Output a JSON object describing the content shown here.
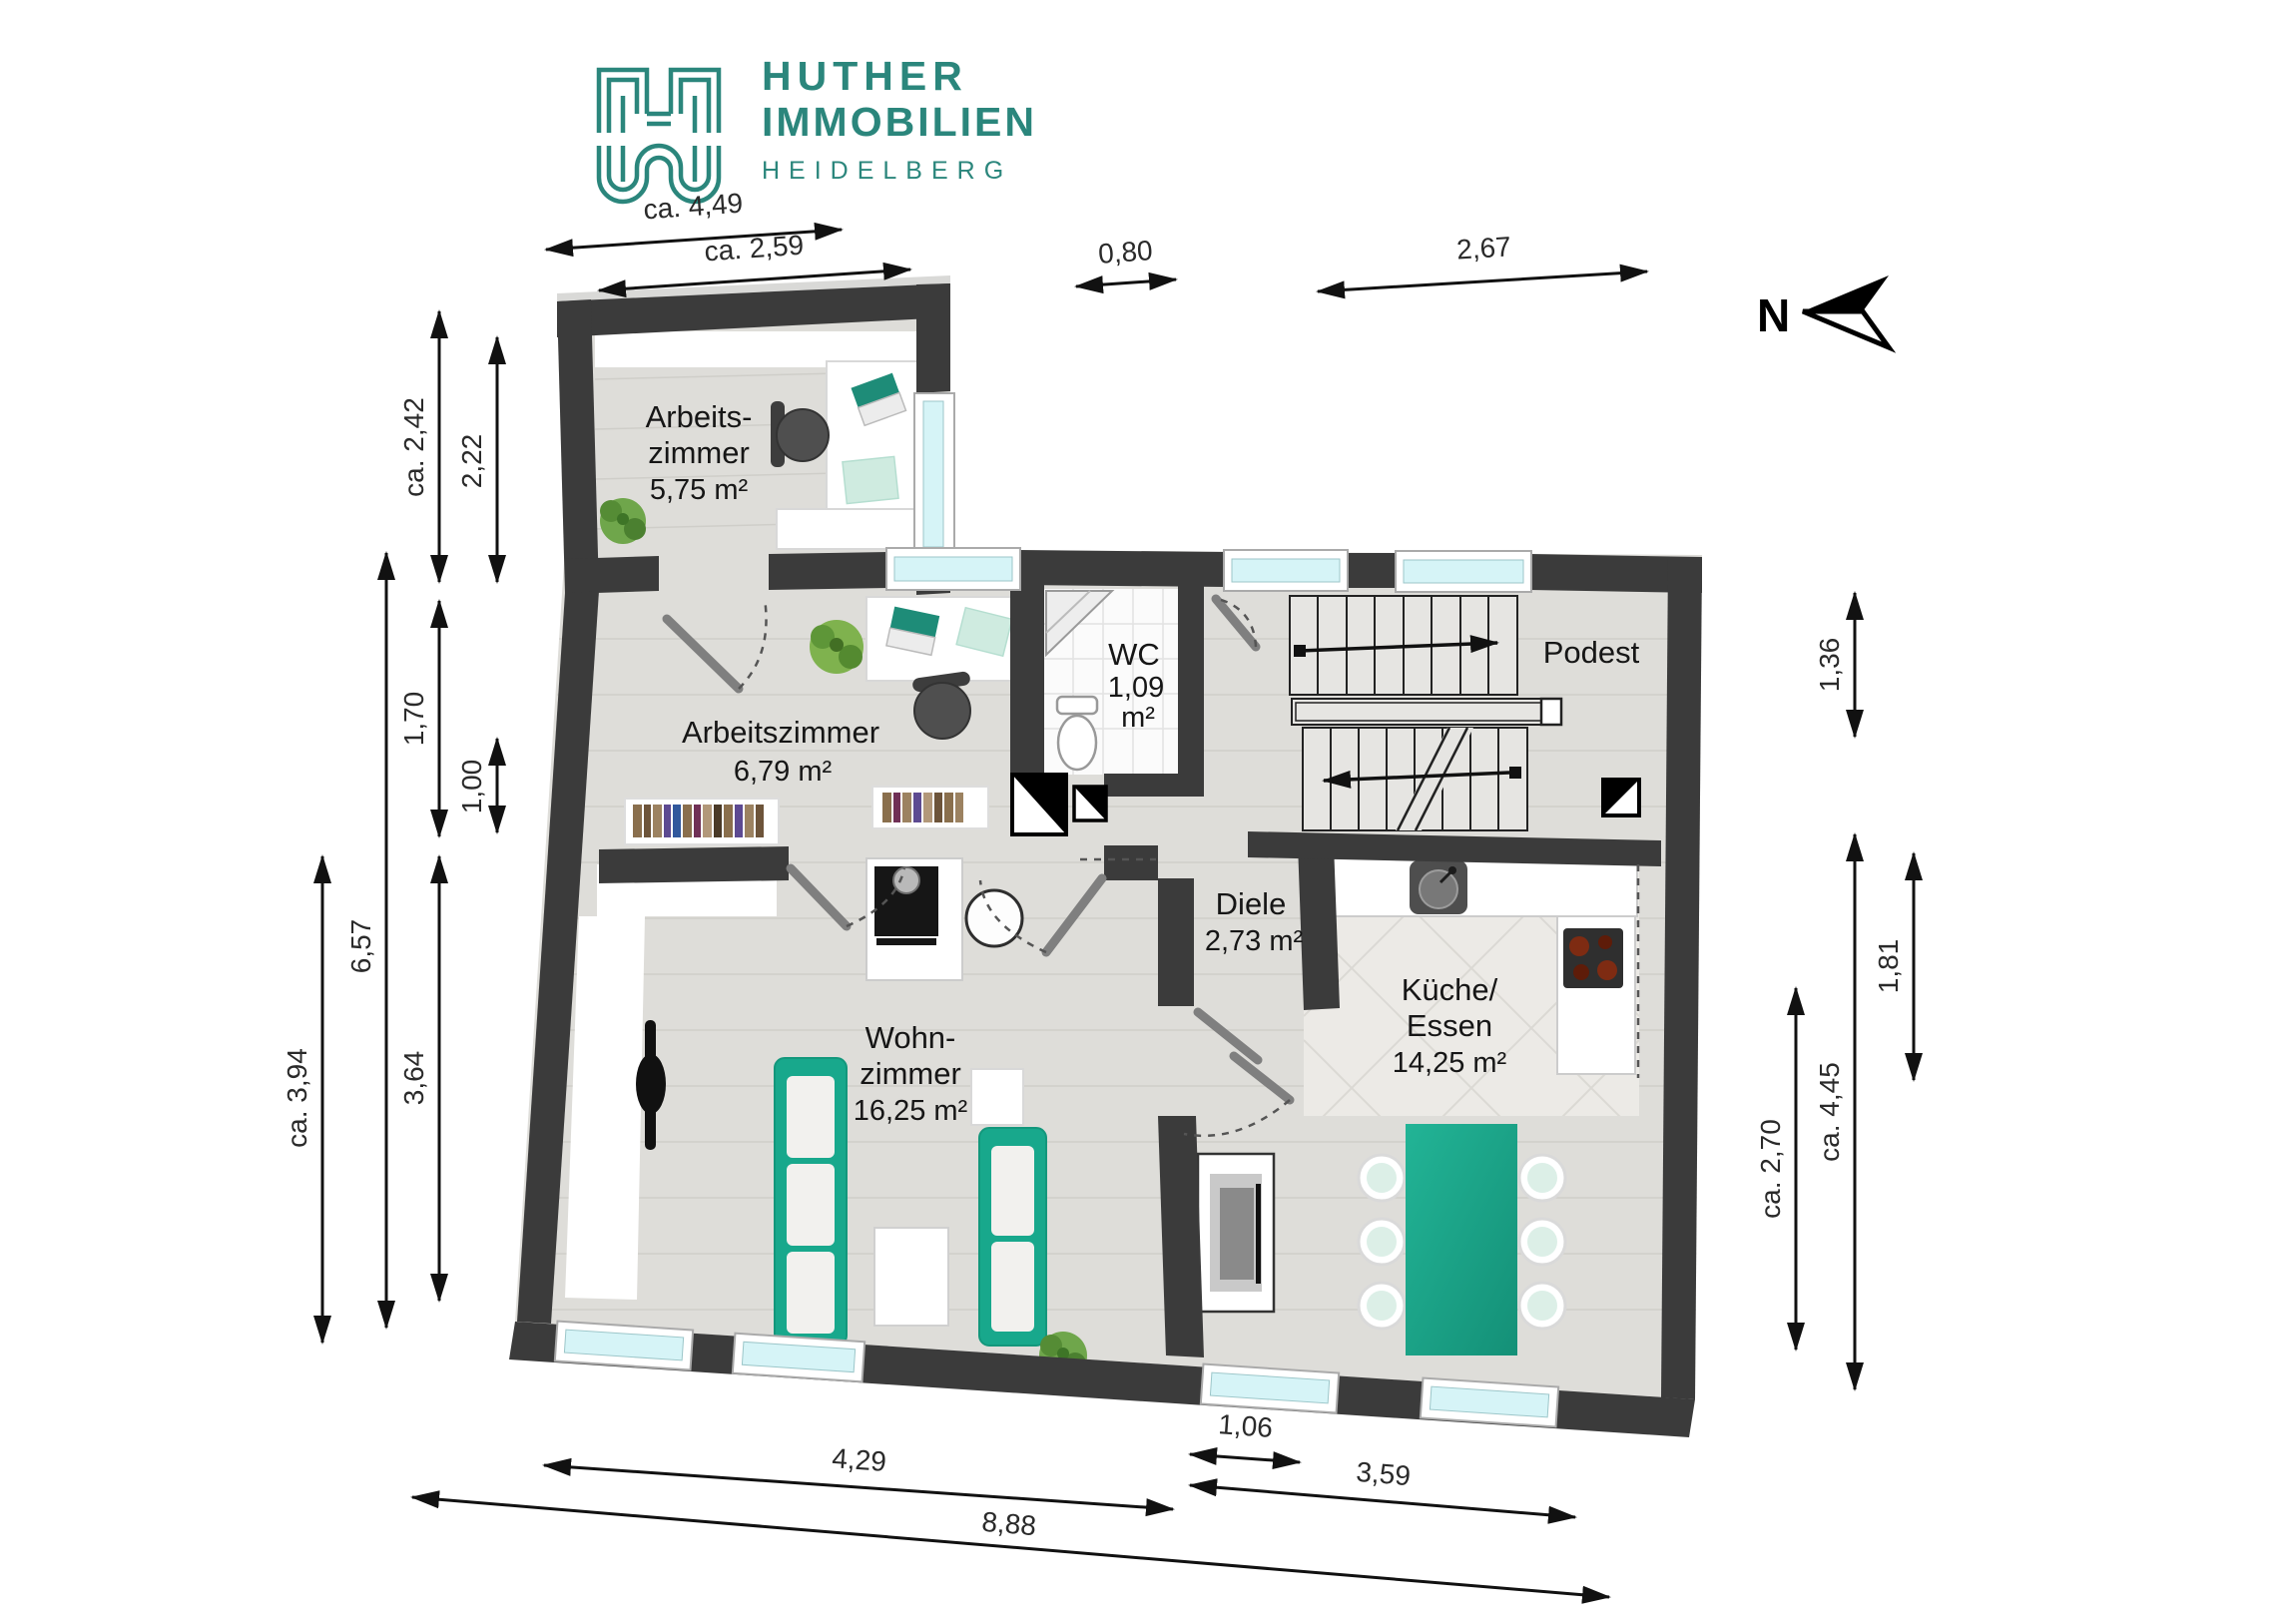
{
  "brand": {
    "line1": "HUTHER",
    "line2": "IMMOBILIEN",
    "line3": "HEIDELBERG",
    "accent_color": "#2B867C"
  },
  "compass": {
    "label": "N"
  },
  "rooms": {
    "az1": {
      "l1": "Arbeits-",
      "l2": "zimmer",
      "area": "5,75 m²"
    },
    "az2": {
      "name": "Arbeitszimmer",
      "area": "6,79 m²"
    },
    "wc": {
      "name": "WC",
      "a1": "1,09",
      "a2": "m²"
    },
    "podest": {
      "name": "Podest"
    },
    "diele": {
      "name": "Diele",
      "area": "2,73 m²"
    },
    "kueche": {
      "l1": "Küche/",
      "l2": "Essen",
      "area": "14,25 m²"
    },
    "wohn": {
      "l1": "Wohn-",
      "l2": "zimmer",
      "area": "16,25 m²"
    }
  },
  "dims": {
    "top": [
      {
        "label": "ca. 4,49"
      },
      {
        "label": "ca. 2,59"
      },
      {
        "label": "0,80"
      },
      {
        "label": "2,67"
      }
    ],
    "left": [
      {
        "label": "ca. 2,42"
      },
      {
        "label": "2,22"
      },
      {
        "label": "1,70"
      },
      {
        "label": "1,00"
      },
      {
        "label": "6,57"
      },
      {
        "label": "ca. 3,94"
      },
      {
        "label": "3,64"
      }
    ],
    "right": [
      {
        "label": "1,36"
      },
      {
        "label": "1,81"
      },
      {
        "label": "ca. 2,70"
      },
      {
        "label": "ca. 4,45"
      }
    ],
    "bottom": [
      {
        "label": "4,29"
      },
      {
        "label": "1,06"
      },
      {
        "label": "3,59"
      },
      {
        "label": "8,88"
      }
    ]
  },
  "colors": {
    "wall": "#3B3B3B",
    "floor": "#DEDDD9",
    "window_glass": "#D6F4F7",
    "accent_teal": "#1CA98C",
    "mint": "#CFEBE0"
  }
}
